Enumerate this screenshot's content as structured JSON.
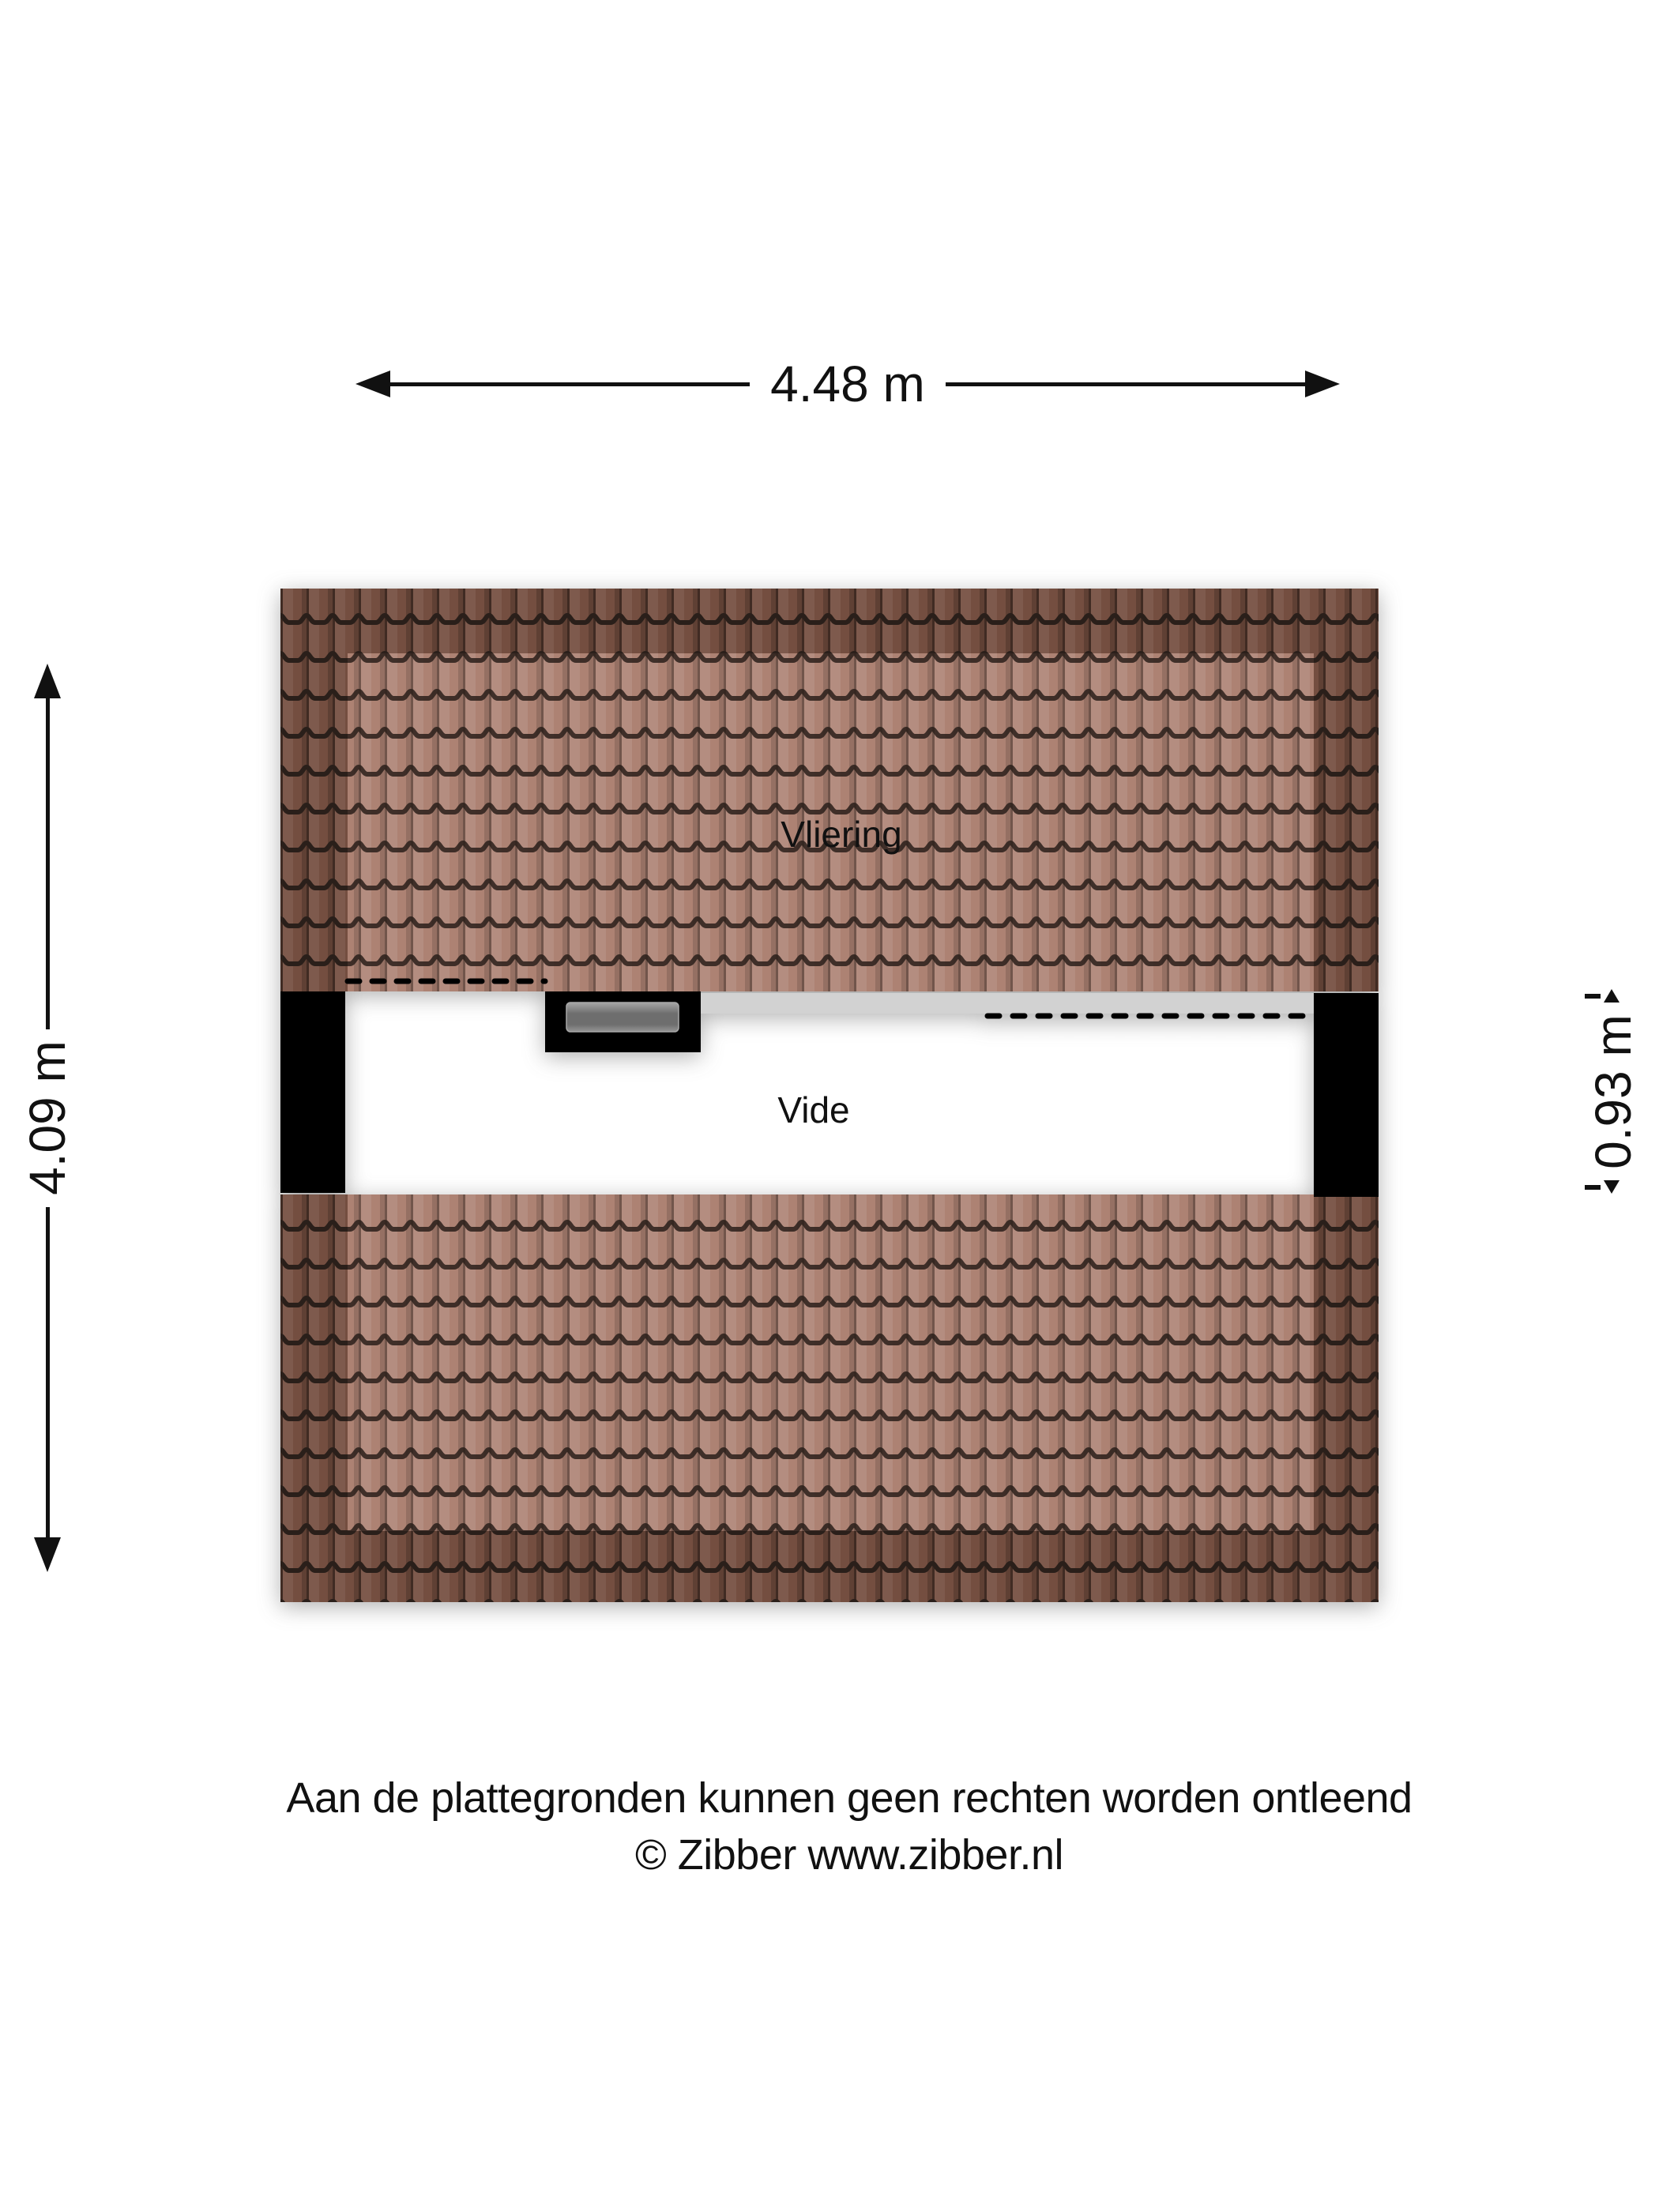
{
  "floorplan": {
    "rooms": [
      {
        "label": "Vliering"
      },
      {
        "label": "Vide"
      }
    ],
    "dimensions": {
      "width_label": "4.48 m",
      "height_label": "4.09 m",
      "void_height_label": "0.93 m"
    },
    "colors": {
      "tile_interior": "#ad8273",
      "tile_border": "#744e40",
      "tile_line": "#2a1f1a",
      "wall": "#000000",
      "overhang_strip": "#d2d2d2",
      "glass_top": "#a6a6a6",
      "glass_mid": "#6e6e6e",
      "glass_bottom": "#949494",
      "glass_frame": "#000000"
    }
  },
  "footer": {
    "disclaimer": "Aan de plattegronden kunnen geen rechten worden ontleend",
    "copyright": "© Zibber www.zibber.nl"
  }
}
